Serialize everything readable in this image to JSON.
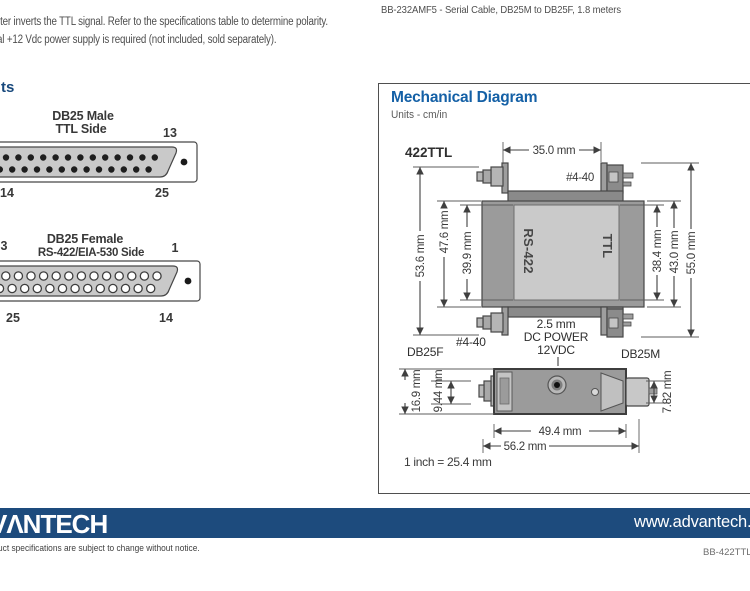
{
  "header": {
    "paragraph_line1": "rter inverts the TTL signal. Refer to the specifications table to determine polarity.",
    "paragraph_line2": "al +12 Vdc power supply is required (not included, sold separately).",
    "cable_item": "BB-232AMF5 - Serial Cable, DB25M to DB25F, 1.8 meters",
    "section_heading_fragment": "ts"
  },
  "pinouts": {
    "male": {
      "title_line1": "DB25 Male",
      "title_line2": "TTL Side",
      "pin_top_right": "13",
      "pin_bottom_left": "14",
      "pin_bottom_right": "25"
    },
    "female": {
      "title_line1": "DB25 Female",
      "title_line2": "RS-422/EIA-530 Side",
      "pin_top_left": "3",
      "pin_top_right": "1",
      "pin_bottom_left": "25",
      "pin_bottom_right": "14"
    }
  },
  "mechanical": {
    "title": "Mechanical Diagram",
    "units_label": "Units - cm/in",
    "model": "422TTL",
    "top_view": {
      "dim_width_top": "35.0 mm",
      "screw_label_top": "#4-40",
      "dim_left_outer": "53.6 mm",
      "dim_left_mid": "47.6 mm",
      "dim_left_inner": "39.9 mm",
      "dim_right_inner": "38.4 mm",
      "dim_right_mid": "43.0 mm",
      "dim_right_outer": "55.0 mm",
      "label_left_side": "RS-422",
      "label_right_side": "TTL",
      "connector_left": "DB25F",
      "screw_label_bottom": "#4-40",
      "power_jack_line1": "2.5 mm",
      "power_jack_line2": "DC POWER",
      "power_jack_line3": "12VDC",
      "connector_right": "DB25M"
    },
    "side_view": {
      "dim_height_overall": "16.9 mm",
      "dim_height_screw": "9.44 mm",
      "dim_height_connector": "7.82 mm",
      "dim_width_body": "49.4 mm",
      "dim_width_overall": "56.2 mm"
    },
    "scale_note": "1 inch = 25.4 mm"
  },
  "footer": {
    "logo_fragment": "VΛNTECH",
    "website": "www.advantech.",
    "disclaimer_fragment": "uct specifications are subject to change without notice.",
    "doc_number_fragment": "BB-422TTL_"
  },
  "colors": {
    "accent_blue": "#1460a6",
    "footer_bar": "#1d4b7d"
  }
}
